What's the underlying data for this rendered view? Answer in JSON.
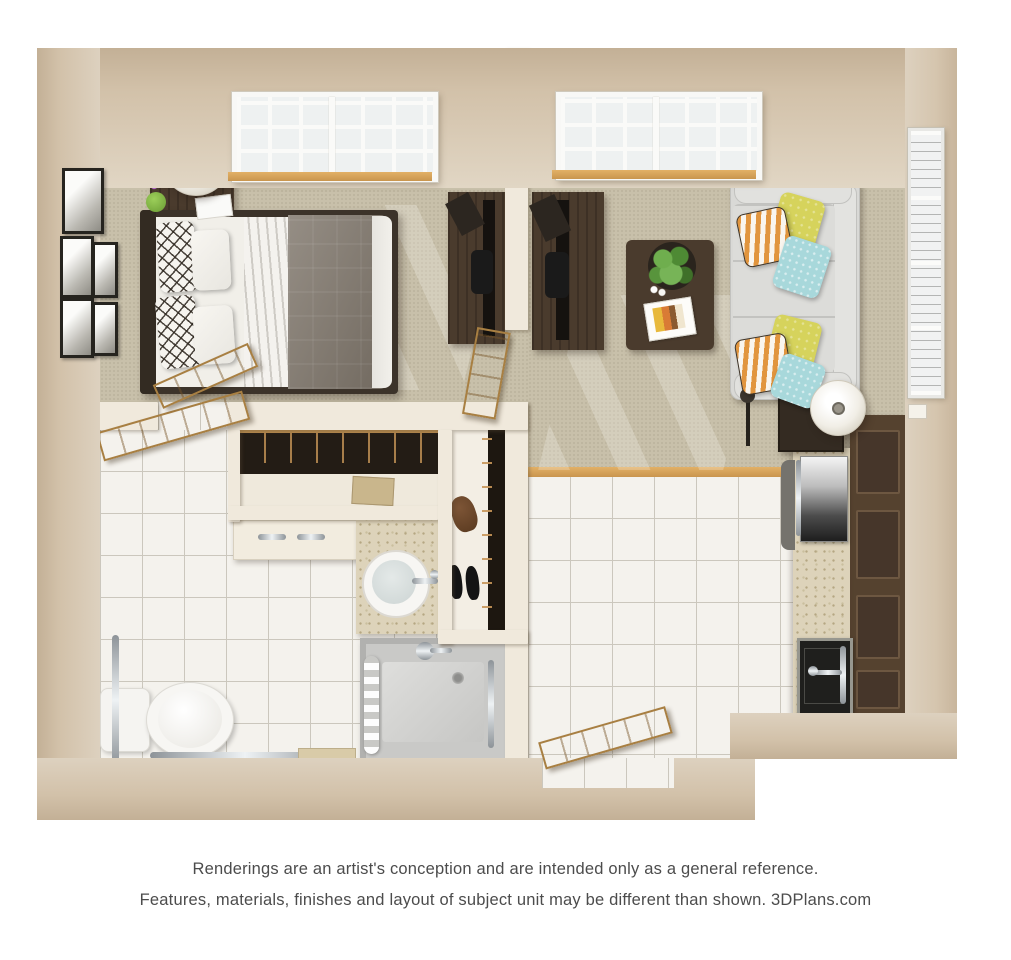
{
  "page": {
    "background": "#ffffff"
  },
  "disclaimer": {
    "line1": "Renderings are an artist's conception and are intended only as a general reference.",
    "line2": "Features, materials, finishes and layout of subject unit may be different than shown. 3DPlans.com"
  },
  "colors": {
    "wall_outer": "#c6b299",
    "wall_face": "#ddd1bf",
    "partition": "#f0e9dc",
    "carpet": "#c8c0aa",
    "tile": "#f4f2ed",
    "grout": "#cbc7bd",
    "wood_trim": "#d8a55e",
    "door_wood": "#d4a964",
    "dark_furniture": "#4a3b2d",
    "cabinet": "#55422f",
    "counter": "#ddd3ba",
    "sofa": "#d9d9d6",
    "pillow_yellow": "#d6d35c",
    "pillow_teal": "#a8d8db",
    "pillow_orange": "#e1953e",
    "comforter": "#7e756a",
    "linen": "#f1efe9",
    "shower_gray": "#c9c9c7",
    "appliance_dark": "#1f1f1d",
    "text": "#4c4c4c"
  },
  "floorplan": {
    "view": "3d-top-down-rendering",
    "layout": "one-bedroom-one-bath-apartment",
    "rooms": [
      {
        "name": "bedroom",
        "position": "top-left",
        "furniture": [
          "queen-bed",
          "gray-comforter",
          "trellis-pillows",
          "nightstand",
          "drum-lamp",
          "flower-vase",
          "wall-art",
          "window",
          "tv-console",
          "tv"
        ]
      },
      {
        "name": "living-room",
        "position": "top-right",
        "furniture": [
          "sofa",
          "throw-pillows",
          "coffee-table",
          "potted-plant",
          "magazines",
          "tv-console",
          "tv",
          "side-table",
          "drum-lamp",
          "floor-lamp",
          "window",
          "tall-window",
          "light-switch"
        ]
      },
      {
        "name": "wardrobe-closet",
        "position": "center",
        "furniture": [
          "hanging-clothes",
          "shelf",
          "storage-box",
          "dresser"
        ]
      },
      {
        "name": "shoe-closet",
        "position": "center-right",
        "furniture": [
          "hanging-clothes",
          "shoes"
        ]
      },
      {
        "name": "bathroom",
        "position": "bottom-left",
        "furniture": [
          "toilet",
          "grab-bars",
          "vanity-sink",
          "walk-in-shower",
          "shower-curtain",
          "shower-head",
          "bath-tray"
        ]
      },
      {
        "name": "kitchen",
        "position": "bottom-right",
        "furniture": [
          "cabinets",
          "countertop",
          "range",
          "kitchen-sink",
          "dishwasher"
        ]
      },
      {
        "name": "entry",
        "position": "bottom-center",
        "furniture": [
          "entry-door"
        ]
      }
    ],
    "doors": [
      "bedroom-door",
      "bathroom-door",
      "living-room-door",
      "entry-door"
    ]
  }
}
